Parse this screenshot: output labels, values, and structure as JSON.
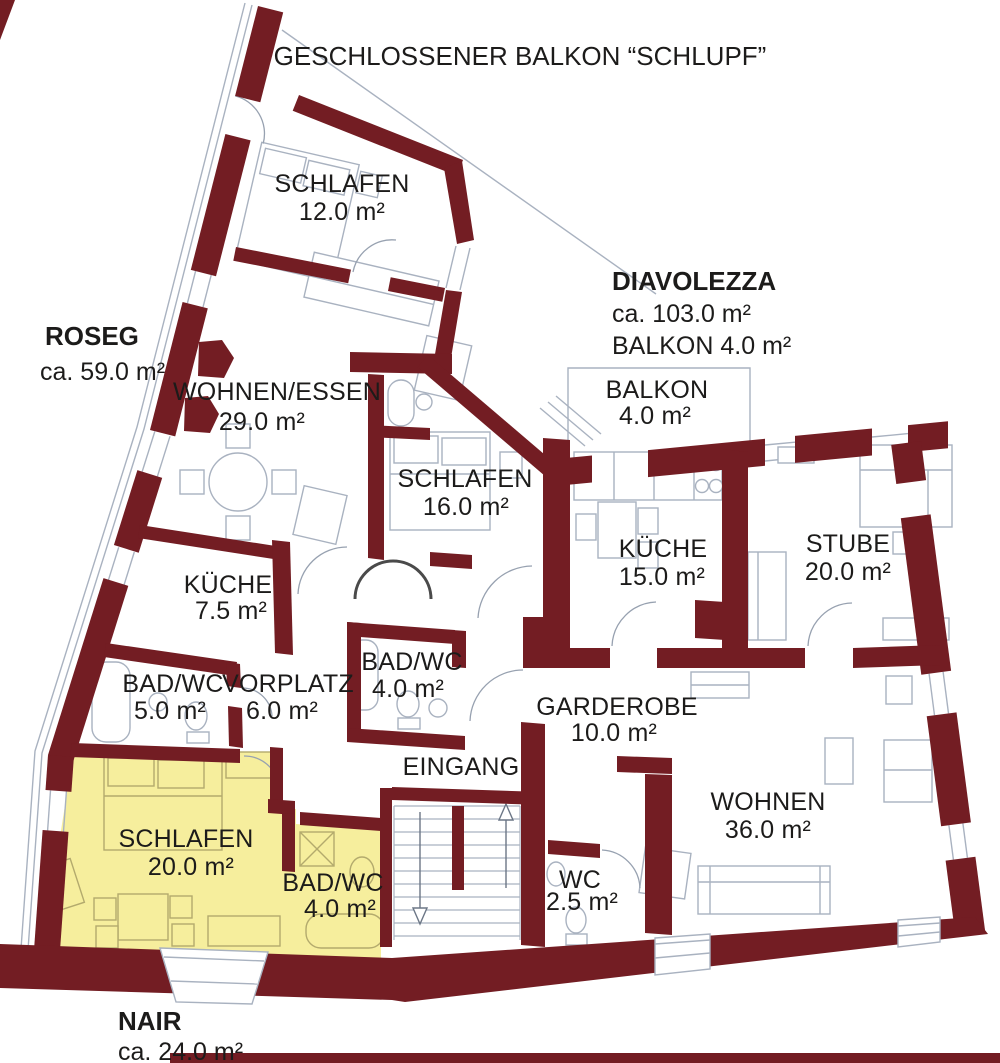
{
  "title": "GESCHLOSSENER BALKON “SCHLUPF”",
  "apartments": {
    "roseg": {
      "name": "ROSEG",
      "area": "ca. 59.0 m²"
    },
    "diavolezza": {
      "name": "DIAVOLEZZA",
      "area": "ca. 103.0 m²",
      "extra": "BALKON 4.0 m²"
    },
    "nair": {
      "name": "NAIR",
      "area": "ca. 24.0 m²"
    }
  },
  "rooms": {
    "schlafen12": {
      "label": "SCHLAFEN",
      "area": "12.0 m²"
    },
    "wohnen_essen": {
      "label": "WOHNEN/ESSEN",
      "area": "29.0 m²"
    },
    "schlafen16": {
      "label": "SCHLAFEN",
      "area": "16.0 m²"
    },
    "kueche15": {
      "label": "KÜCHE",
      "area": "15.0 m²"
    },
    "stube": {
      "label": "STUBE",
      "area": "20.0 m²"
    },
    "balkon": {
      "label": "BALKON",
      "area": "4.0 m²"
    },
    "kueche75": {
      "label": "KÜCHE",
      "area": "7.5 m²"
    },
    "badwc5": {
      "label": "BAD/WC",
      "area": "5.0 m²"
    },
    "vorplatz": {
      "label": "VORPLATZ",
      "area": "6.0 m²"
    },
    "badwc4_mitte": {
      "label": "BAD/WC",
      "area": "4.0 m²"
    },
    "garderobe": {
      "label": "GARDEROBE",
      "area": "10.0 m²"
    },
    "eingang": {
      "label": "EINGANG"
    },
    "schlafen20": {
      "label": "SCHLAFEN",
      "area": "20.0 m²"
    },
    "badwc4_nair": {
      "label": "BAD/WC",
      "area": "4.0 m²"
    },
    "wohnen36": {
      "label": "WOHNEN",
      "area": "36.0 m²"
    },
    "wc25": {
      "label": "WC",
      "area": "2.5 m²"
    }
  },
  "colors": {
    "wall": "#731d23",
    "highlight": "#f6ee9d",
    "line": "#a9b2c0",
    "lineYellow": "#b3aa6d",
    "arc": "#97a1b0",
    "arrow": "#6b7686",
    "archDark": "#4a4a4a",
    "text": "#1c1b1a"
  }
}
